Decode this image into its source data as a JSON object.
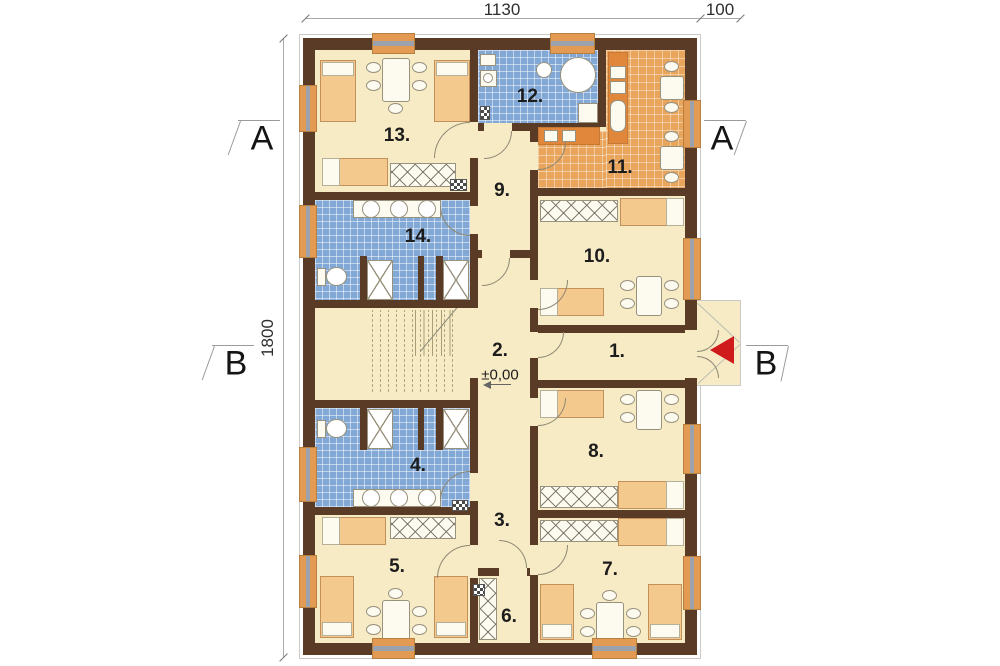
{
  "title": "Floor plan",
  "dimensions": {
    "top_width": "1130",
    "top_porch": "100",
    "left_height": "1800"
  },
  "section_markers": {
    "a": "A",
    "b": "B"
  },
  "level_marker": "±0,00",
  "rooms": [
    {
      "label": "1."
    },
    {
      "label": "2."
    },
    {
      "label": "3."
    },
    {
      "label": "4."
    },
    {
      "label": "5."
    },
    {
      "label": "6."
    },
    {
      "label": "7."
    },
    {
      "label": "8."
    },
    {
      "label": "9."
    },
    {
      "label": "10."
    },
    {
      "label": "11."
    },
    {
      "label": "12."
    },
    {
      "label": "13."
    },
    {
      "label": "14."
    }
  ],
  "legend": {
    "blue_rooms": "bathrooms (4, 12, 14)",
    "orange_room": "kitchen (11)",
    "entrance": "red arrow at porch"
  },
  "colors": {
    "wall": "#5a3b26",
    "floor": "#f7ebc5",
    "tileB": "#82a9d6",
    "tileO": "#e9a55b",
    "counter": "#e0873c",
    "bed": "#f4c98e",
    "bedL": "#c29058",
    "furn": "#fdfaef",
    "furnL": "#97917e",
    "winO": "#e39b54",
    "winG": "#9aa3ad",
    "red": "#cf1b1b",
    "dim": "#a9a9a9",
    "ink": "#1c1c1c",
    "outl": "#c9c9c9"
  }
}
